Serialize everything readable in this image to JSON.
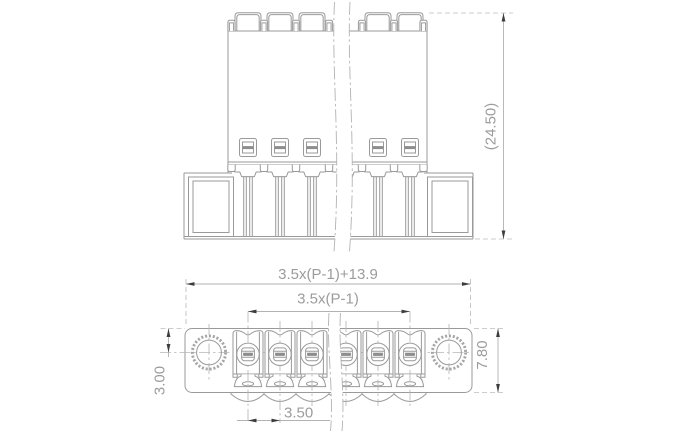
{
  "drawing": {
    "dimensions": {
      "overall_height": "(24.50)",
      "total_width": "3.5x(P-1)+13.9",
      "pin_span": "3.5x(P-1)",
      "pitch": "3.50",
      "mount_hole_offset": "3.00",
      "body_depth": "7.80"
    },
    "colors": {
      "background": "#ffffff",
      "part_line": "#9a9a9a",
      "dimension_line": "#b7b7b7",
      "label_text": "#9c9c9c",
      "arrowhead": "#3d3d3d"
    }
  }
}
